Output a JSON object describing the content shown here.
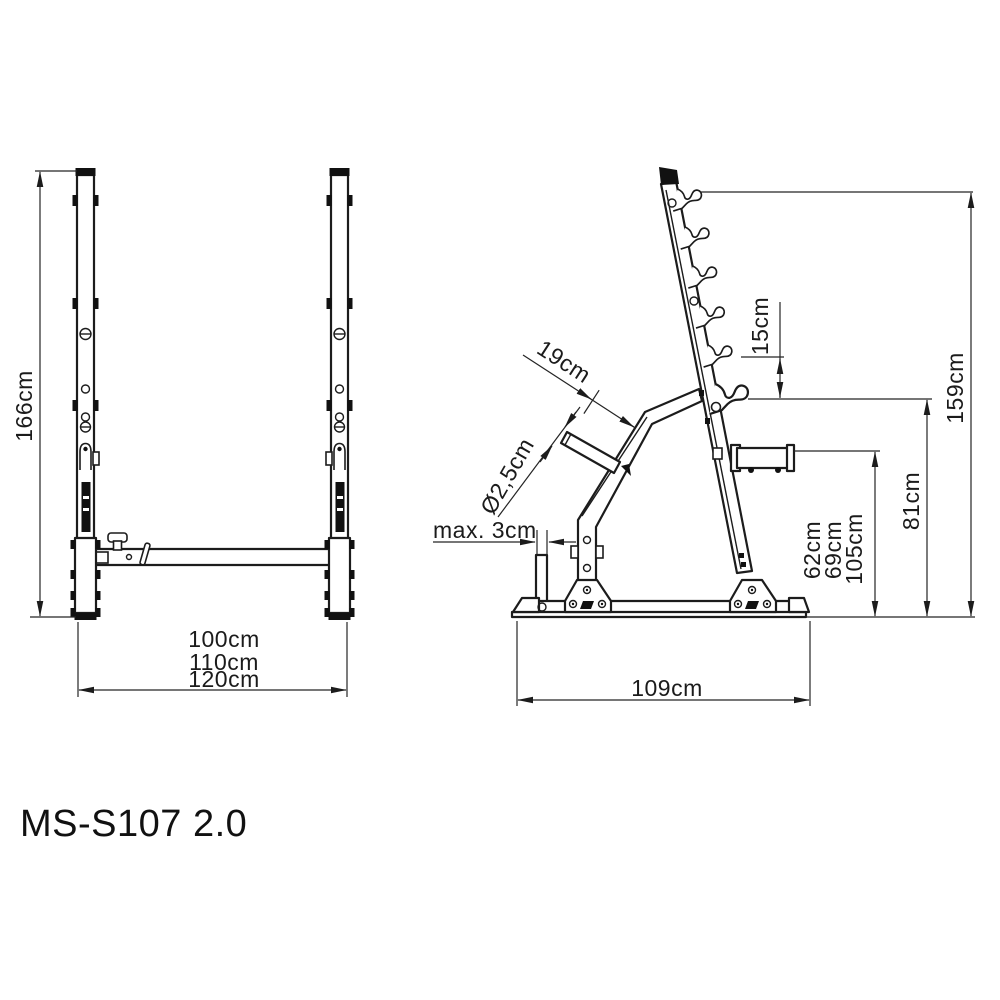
{
  "title": "MS-S107 2.0",
  "colors": {
    "ink": "#1c1c1c",
    "background": "#ffffff"
  },
  "front_view": {
    "description": "front view of rack stands",
    "height": "166cm",
    "width_options": [
      "100cm",
      "110cm",
      "120cm"
    ]
  },
  "side_view": {
    "description": "side view of rack with dumbbell hooks",
    "total_height": "159cm",
    "hook_spacing": "15cm",
    "barbell_rest_height": "81cm",
    "spotter_height_options": [
      "62cm",
      "69cm",
      "105cm"
    ],
    "rest_arm_length": "19cm",
    "peg_diameter": "Ø2,5cm",
    "max_bar_gap": "max. 3cm",
    "base_depth": "109cm"
  }
}
